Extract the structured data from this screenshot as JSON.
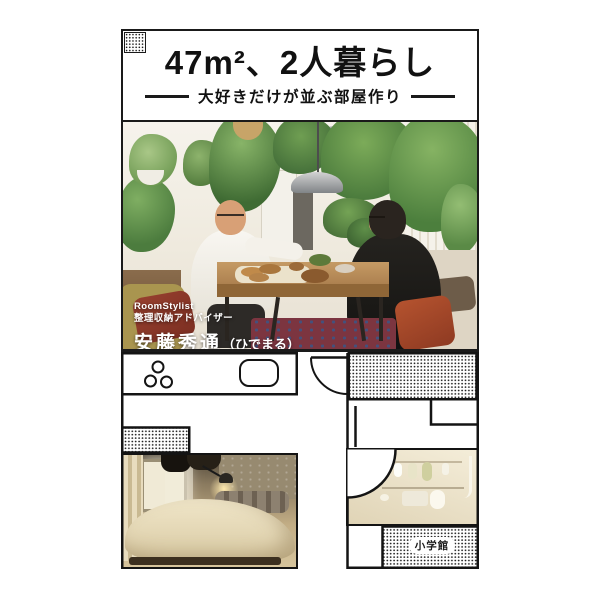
{
  "cover": {
    "title_box": {
      "title_number": "47",
      "title_unit": "m²",
      "title_rest": "、2人暮らし",
      "subtitle": "大好きだけが並ぶ部屋作り"
    },
    "author_overlay": {
      "role_line1": "RoomStylist",
      "role_line2": "整理収納アドバイザー",
      "name": "安藤秀通",
      "nickname": "（ひでまる）"
    },
    "publisher": "小学館",
    "colors": {
      "frame": "#1a1a1a",
      "paper": "#ffffff",
      "accent_cushion": "#b5532f",
      "plant_green": "#6da14f"
    }
  }
}
